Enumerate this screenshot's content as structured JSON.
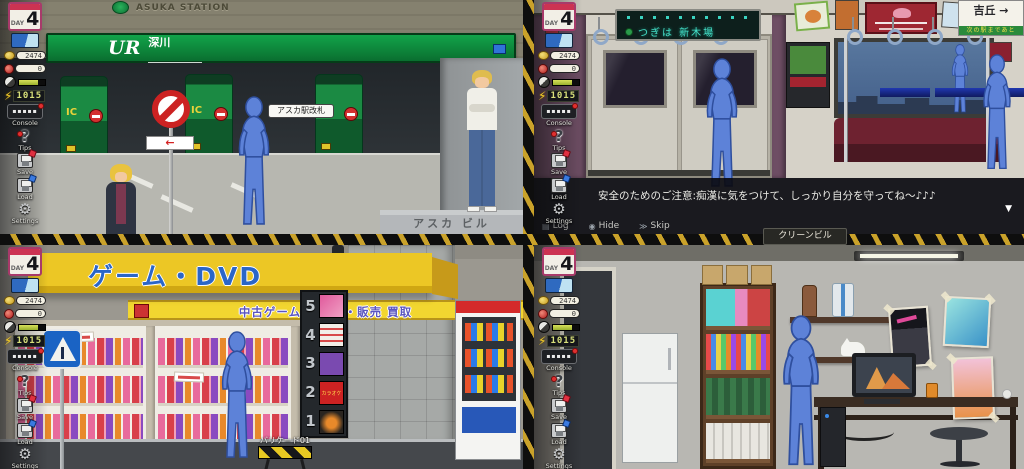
{
  "hud": {
    "day_label": "DAY",
    "day_value": "4",
    "coin_count": "2474",
    "gem_count": "0",
    "energy_count": "1015",
    "console_label": "Console",
    "tips_label": "Tips",
    "save_label": "Save",
    "load_label": "Load",
    "settings_label": "Settings"
  },
  "icons": {
    "console_dashes": "▪▪▪▪▪",
    "tips_question": "?",
    "energy_bolt": "⚡",
    "settings_gear": "⚙",
    "log_icon": "▤",
    "hide_icon": "◉",
    "skip_icon": "≫",
    "continue_marker": "▼",
    "arrow_left": "←"
  },
  "station": {
    "wall_text": "ASUKA STATION",
    "sign_logo": "UR",
    "sign_name": "深川",
    "gate_ic": "IC",
    "gate_tooltip": "アスカ駅改札",
    "ledge_text": "アスカ ビル"
  },
  "train": {
    "led_text": "つぎは 新木場",
    "hanging_sign_text": "吉丘 →",
    "hanging_sign_sub": "次の駅まであと",
    "dialog_text": "安全のためのご注意:痴漢に気をつけて、しっかり自分を守ってね〜♪♪♪",
    "log_label": "Log",
    "hide_label": "Hide",
    "skip_label": "Skip"
  },
  "shop": {
    "awning_text": "ゲーム・DVD",
    "band_text": "中古ゲーム・DVD・販売 買取",
    "floor_numbers": [
      "5",
      "4",
      "3",
      "2",
      "1"
    ],
    "floor2_ad_text": "カラオケ館",
    "barricade_label": "バリケード01"
  },
  "room": {
    "nameplate_text": "クリーンビル"
  },
  "colors": {
    "hazard_yellow": "#caa22a",
    "jr_green": "#0f9a44",
    "awning_yellow": "#ecc725",
    "mannequin_blue": "#5d82d8",
    "seat_red": "#6e2230",
    "led_teal": "#45e0c8"
  }
}
